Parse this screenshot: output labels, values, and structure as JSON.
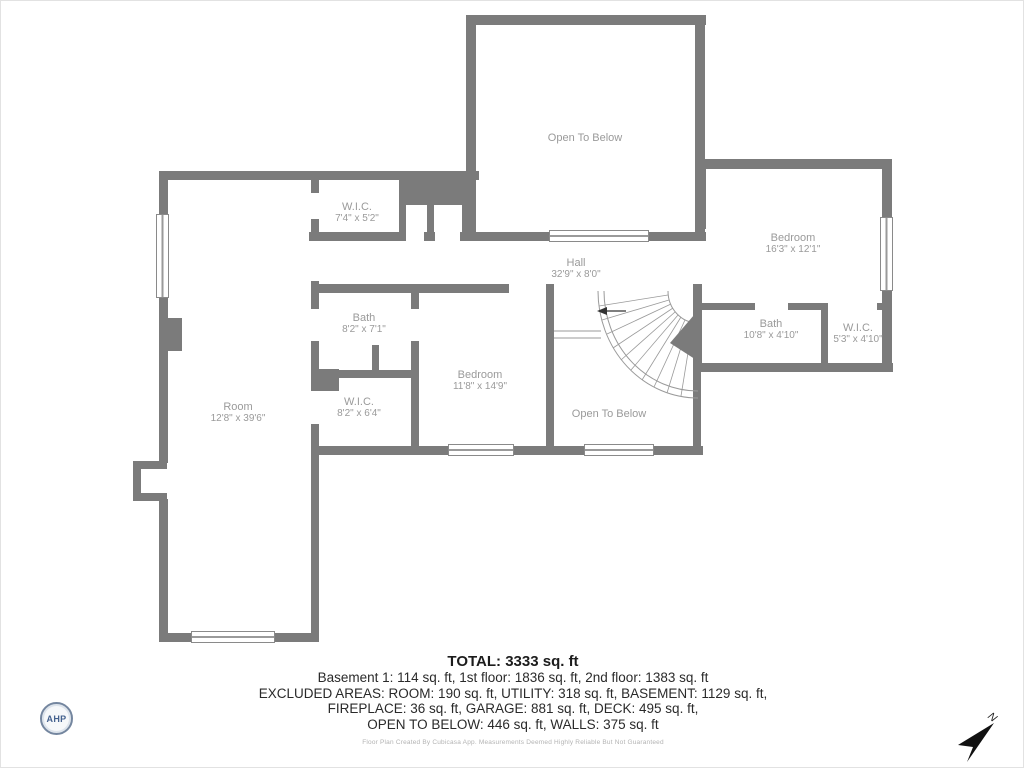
{
  "plan": {
    "rooms": {
      "otb_top": {
        "name": "Open To Below"
      },
      "wic_top": {
        "name": "W.I.C.",
        "dims": "7'4\" x 5'2\""
      },
      "bedroom_right": {
        "name": "Bedroom",
        "dims": "16'3\" x 12'1\""
      },
      "hall": {
        "name": "Hall",
        "dims": "32'9\" x 8'0\""
      },
      "bath_left": {
        "name": "Bath",
        "dims": "8'2\" x 7'1\""
      },
      "bedroom_mid": {
        "name": "Bedroom",
        "dims": "11'8\" x 14'9\""
      },
      "wic_left": {
        "name": "W.I.C.",
        "dims": "8'2\" x 6'4\""
      },
      "room": {
        "name": "Room",
        "dims": "12'8\" x 39'6\""
      },
      "otb_bottom": {
        "name": "Open To Below"
      },
      "bath_right": {
        "name": "Bath",
        "dims": "10'8\" x 4'10\""
      },
      "wic_right": {
        "name": "W.I.C.",
        "dims": "5'3\" x 4'10\""
      }
    }
  },
  "summary": {
    "total": "TOTAL: 3333 sq. ft",
    "line1": "Basement 1: 114 sq. ft, 1st floor: 1836 sq. ft, 2nd floor: 1383 sq. ft",
    "line2": "EXCLUDED AREAS: ROOM: 190 sq. ft, UTILITY: 318 sq. ft, BASEMENT: 1129 sq. ft,",
    "line3": "FIREPLACE: 36 sq. ft, GARAGE: 881 sq. ft, DECK: 495 sq. ft,",
    "line4": "OPEN TO BELOW: 446 sq. ft, WALLS: 375 sq. ft",
    "disclaimer": "Floor Plan Created By Cubicasa App. Measurements Deemed Highly Reliable But Not Guaranteed"
  },
  "branding": {
    "logo_text": "AHP"
  },
  "compass": {
    "label": "N"
  },
  "colors": {
    "wall": "#7b7b7b",
    "room_label": "#9a9a9a",
    "summary_text": "#2a2a2a"
  }
}
